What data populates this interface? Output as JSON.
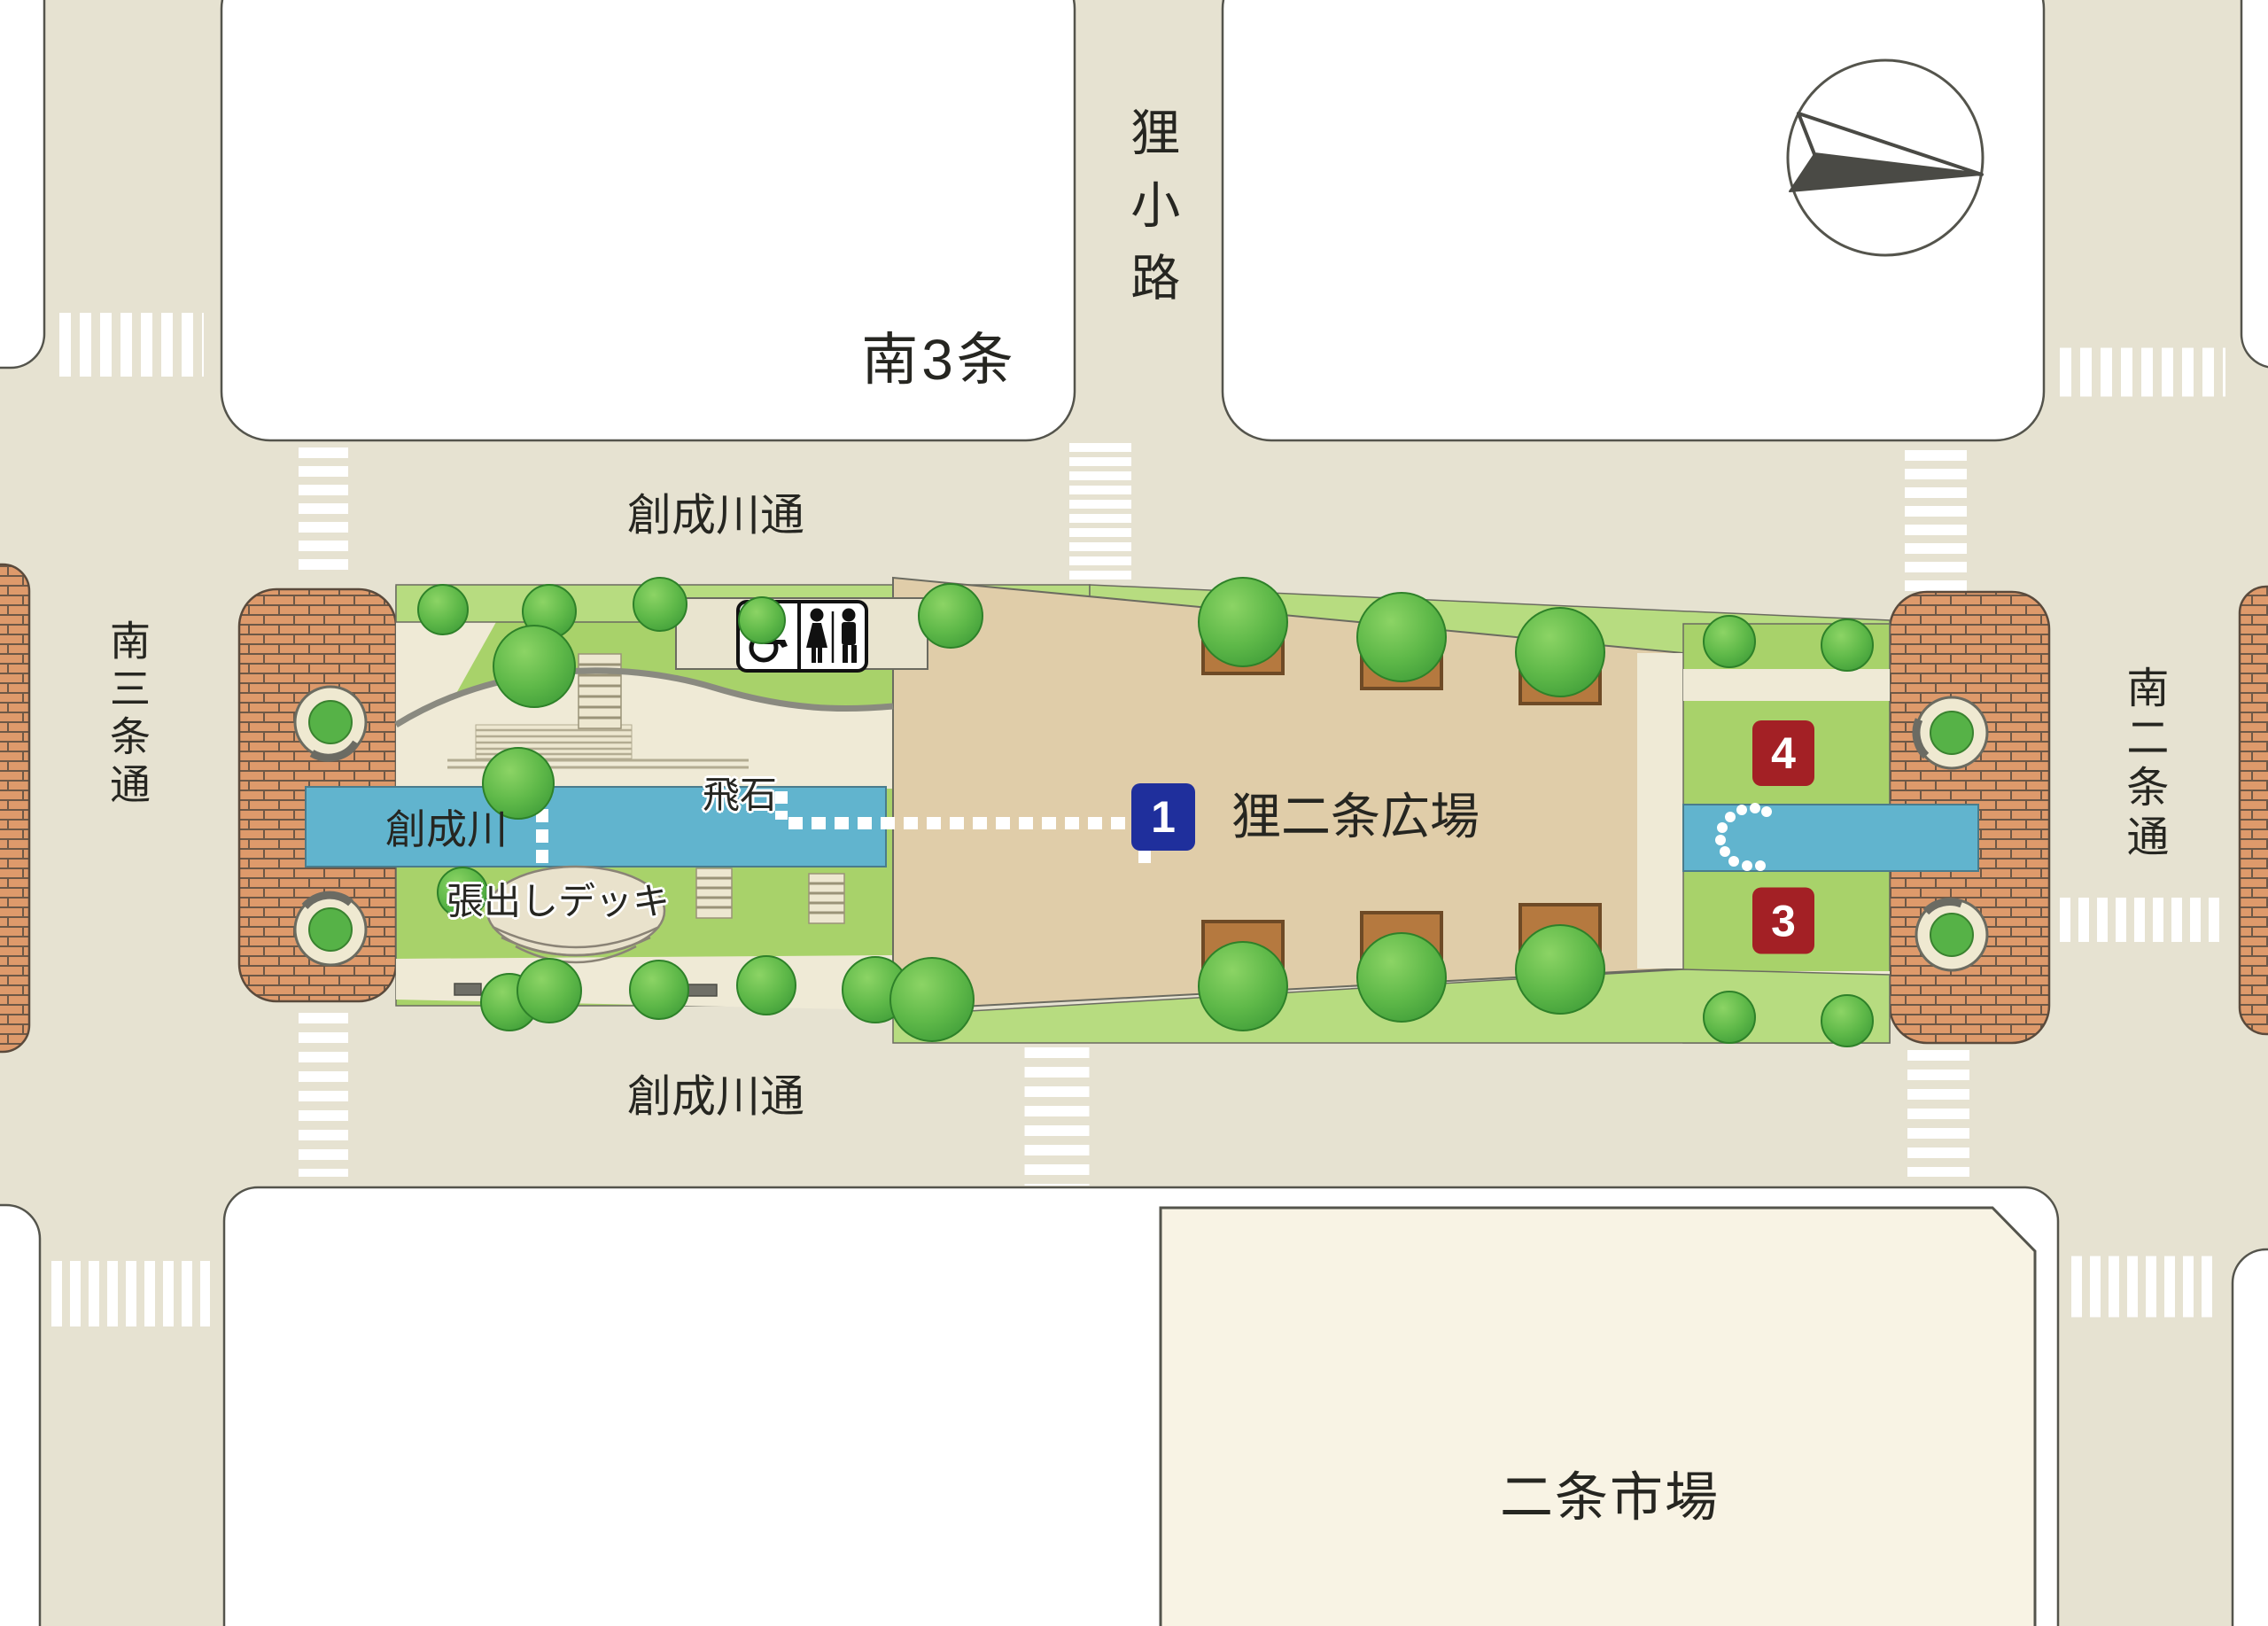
{
  "map": {
    "blocks": {
      "south3jo_block_label": "南3条",
      "market_label": "二条市場"
    },
    "roads": {
      "tanukikoji_label": "狸小路",
      "sosei_dori_north_label": "創成川通",
      "sosei_dori_south_label": "創成川通",
      "minami_3jo_dori_label": "南三条通",
      "minami_2jo_dori_label": "南二条通"
    },
    "features": {
      "river_label": "創成川",
      "stepping_stones_label": "飛石",
      "deck_label": "張出しデッキ",
      "plaza_label": "狸二条広場"
    },
    "badges": {
      "plaza_number": "1",
      "spot_3": "3",
      "spot_4": "4"
    },
    "icons": {
      "toilet_sign": "wheelchair-woman-man",
      "compass": "north-arrow"
    },
    "colors": {
      "road": "#E6E2D1",
      "block_white": "#FFFFFF",
      "market_fill": "#F8F3E4",
      "brick": "#DE9A6B",
      "lawn_green": "#A8D26A",
      "strip_green": "#B7DC80",
      "path_cream": "#EFEAD6",
      "river_blue": "#61B4CE",
      "plaza_tan": "#E0CDA9",
      "badge_blue": "#1F2F9C",
      "badge_red": "#A32025",
      "planter_brown": "#B5793F"
    }
  }
}
